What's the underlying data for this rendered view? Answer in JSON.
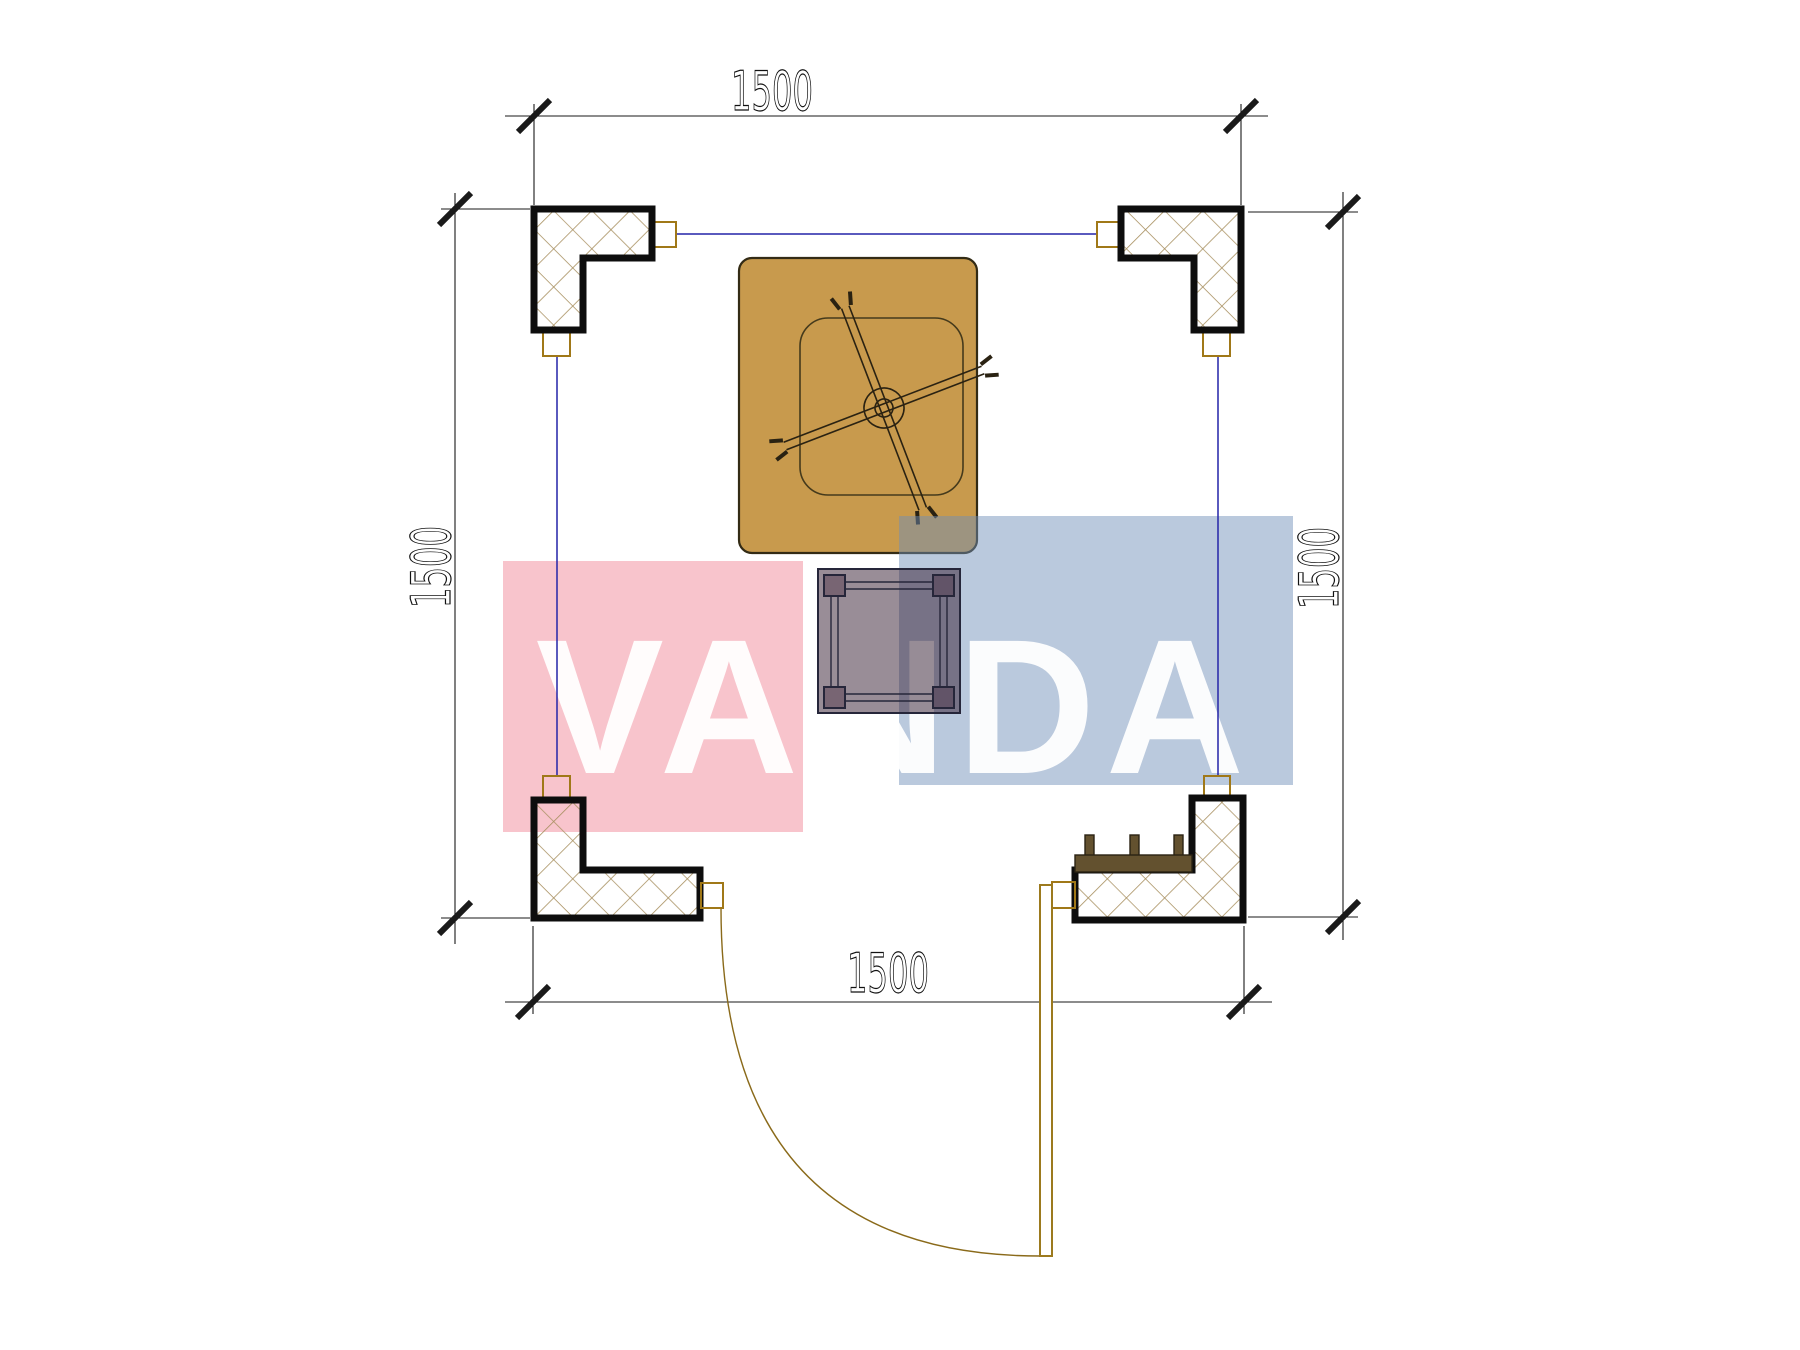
{
  "drawing_type": "architectural-floor-plan",
  "dimensions": {
    "top_label": "1500",
    "bottom_label": "1500",
    "left_label": "1500",
    "right_label": "1500"
  },
  "watermark": {
    "text": "VANDA",
    "red_block_color": "#E73C55",
    "blue_block_color": "#6E8FB8",
    "letter_color": "#FFFFFF"
  },
  "colors": {
    "background": "#FFFFFF",
    "column_outline": "#0D0D0D",
    "hatch_line": "#A89060",
    "axis_line": "#2424A8",
    "connector_outline": "#A07818",
    "table_top_fill": "#C89A4D",
    "table_top_outline": "#332B15",
    "small_table_fill_overlay": "rgba(52,28,48,0.50)",
    "bench_fill": "#63512F",
    "door_line": "#9C7A1E",
    "dimension_line": "#1A1A1A"
  },
  "elements": {
    "columns": [
      "top-left",
      "top-right",
      "bottom-left",
      "bottom-right"
    ],
    "furniture": [
      "square-table-with-umbrella",
      "small-square-table",
      "bench-with-posts"
    ],
    "door": "single-swing-door-bottom"
  }
}
